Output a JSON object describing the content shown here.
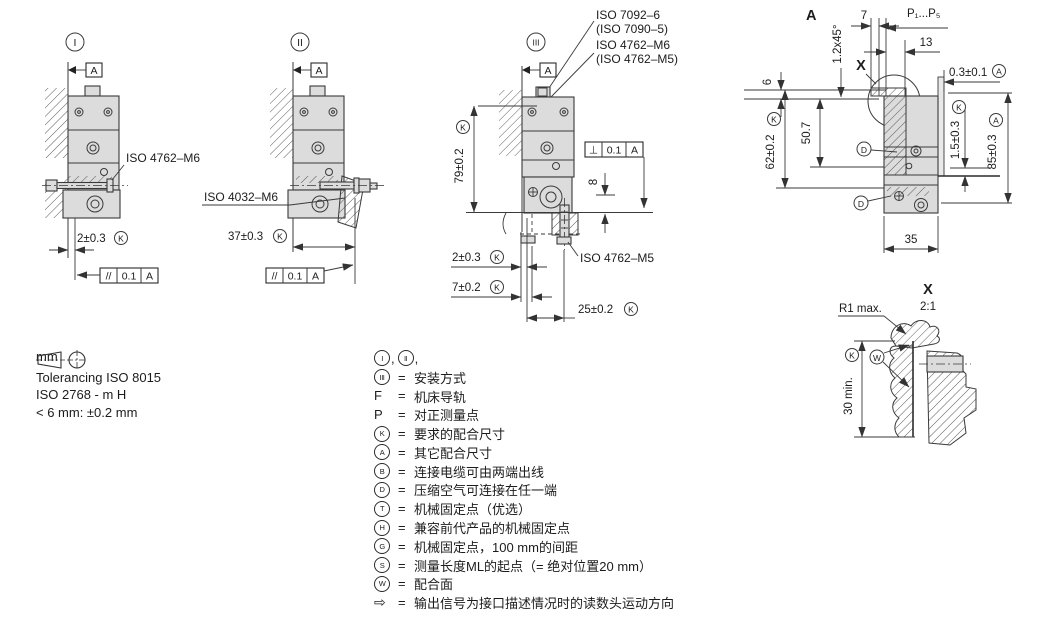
{
  "notes": {
    "unit": "mm",
    "tolerancing": "Tolerancing ISO 8015",
    "iso2768": "ISO 2768 - m H",
    "under6": "< 6 mm: ±0.2 mm"
  },
  "view1": {
    "label": "I",
    "datum": "A",
    "screw_label": "ISO 4762–M6",
    "dim_gap": "2±0.3",
    "dim_gap_mark": "K",
    "fcf_sym": "//",
    "fcf_tol": "0.1",
    "fcf_ref": "A"
  },
  "view2": {
    "label": "II",
    "datum": "A",
    "nut_label": "ISO 4032–M6",
    "dim_width": "37±0.3",
    "dim_width_mark": "K",
    "fcf_sym": "//",
    "fcf_tol": "0.1",
    "fcf_ref": "A"
  },
  "view3": {
    "label": "III",
    "datum": "A",
    "washer_label": "ISO 7092–6",
    "washer_label_alt": "(ISO 7090–5)",
    "screw_label": "ISO 4762–M6",
    "screw_label_alt": "(ISO 4762–M5)",
    "screw_bottom_label": "ISO 4762–M5",
    "dim_height": "79±0.2",
    "dim_height_mark": "K",
    "dim_depth": "8",
    "dim_gap": "2±0.3",
    "dim_gap_mark": "K",
    "dim_offset": "7±0.2",
    "dim_offset_mark": "K",
    "dim_spacing": "25±0.2",
    "dim_spacing_mark": "K",
    "fcf_sym": "⊥",
    "fcf_tol": "0.1",
    "fcf_ref": "A"
  },
  "viewA": {
    "label": "A",
    "dim_width7": "7",
    "dim_points": "P₁...P₅",
    "dim_13": "13",
    "chamfer": "1.2x45°",
    "detail_ref": "X",
    "dim_gap": "0.3±0.1",
    "dim_gap_mark": "A",
    "dim_6": "6",
    "dim_507": "50.7",
    "dim_62": "62±0.2",
    "dim_62_mark": "K",
    "dim_15": "1.5±0.3",
    "dim_15_mark": "K",
    "dim_85": "85±0.3",
    "dim_85_mark": "A",
    "dim_35": "35",
    "port": "D"
  },
  "detailX": {
    "label": "X",
    "scale": "2:1",
    "radius": "R1 max.",
    "dim_clearance": "30 min.",
    "dim_clearance_mark": "K",
    "surface": "W"
  },
  "legend": {
    "eq": "=",
    "comma": ",",
    "intro_a": "I",
    "intro_b": "II",
    "rows": [
      {
        "sym": "III",
        "text": "安装方式"
      },
      {
        "sym": "F",
        "text": "机床导轨"
      },
      {
        "sym": "P",
        "text": "对正测量点"
      },
      {
        "sym": "K",
        "text": "要求的配合尺寸"
      },
      {
        "sym": "A",
        "text": "其它配合尺寸"
      },
      {
        "sym": "B",
        "text": "连接电缆可由两端出线"
      },
      {
        "sym": "D",
        "text": "压缩空气可连接在任一端"
      },
      {
        "sym": "T",
        "text": "机械固定点（优选）"
      },
      {
        "sym": "H",
        "text": "兼容前代产品的机械固定点"
      },
      {
        "sym": "G",
        "text": "机械固定点，100 mm的间距"
      },
      {
        "sym": "S",
        "text": "测量长度ML的起点（= 绝对位置20 mm）"
      },
      {
        "sym": "W",
        "text": "配合面"
      },
      {
        "sym": "⇨",
        "text": "输出信号为接口描述情况时的读数头运动方向"
      }
    ]
  }
}
